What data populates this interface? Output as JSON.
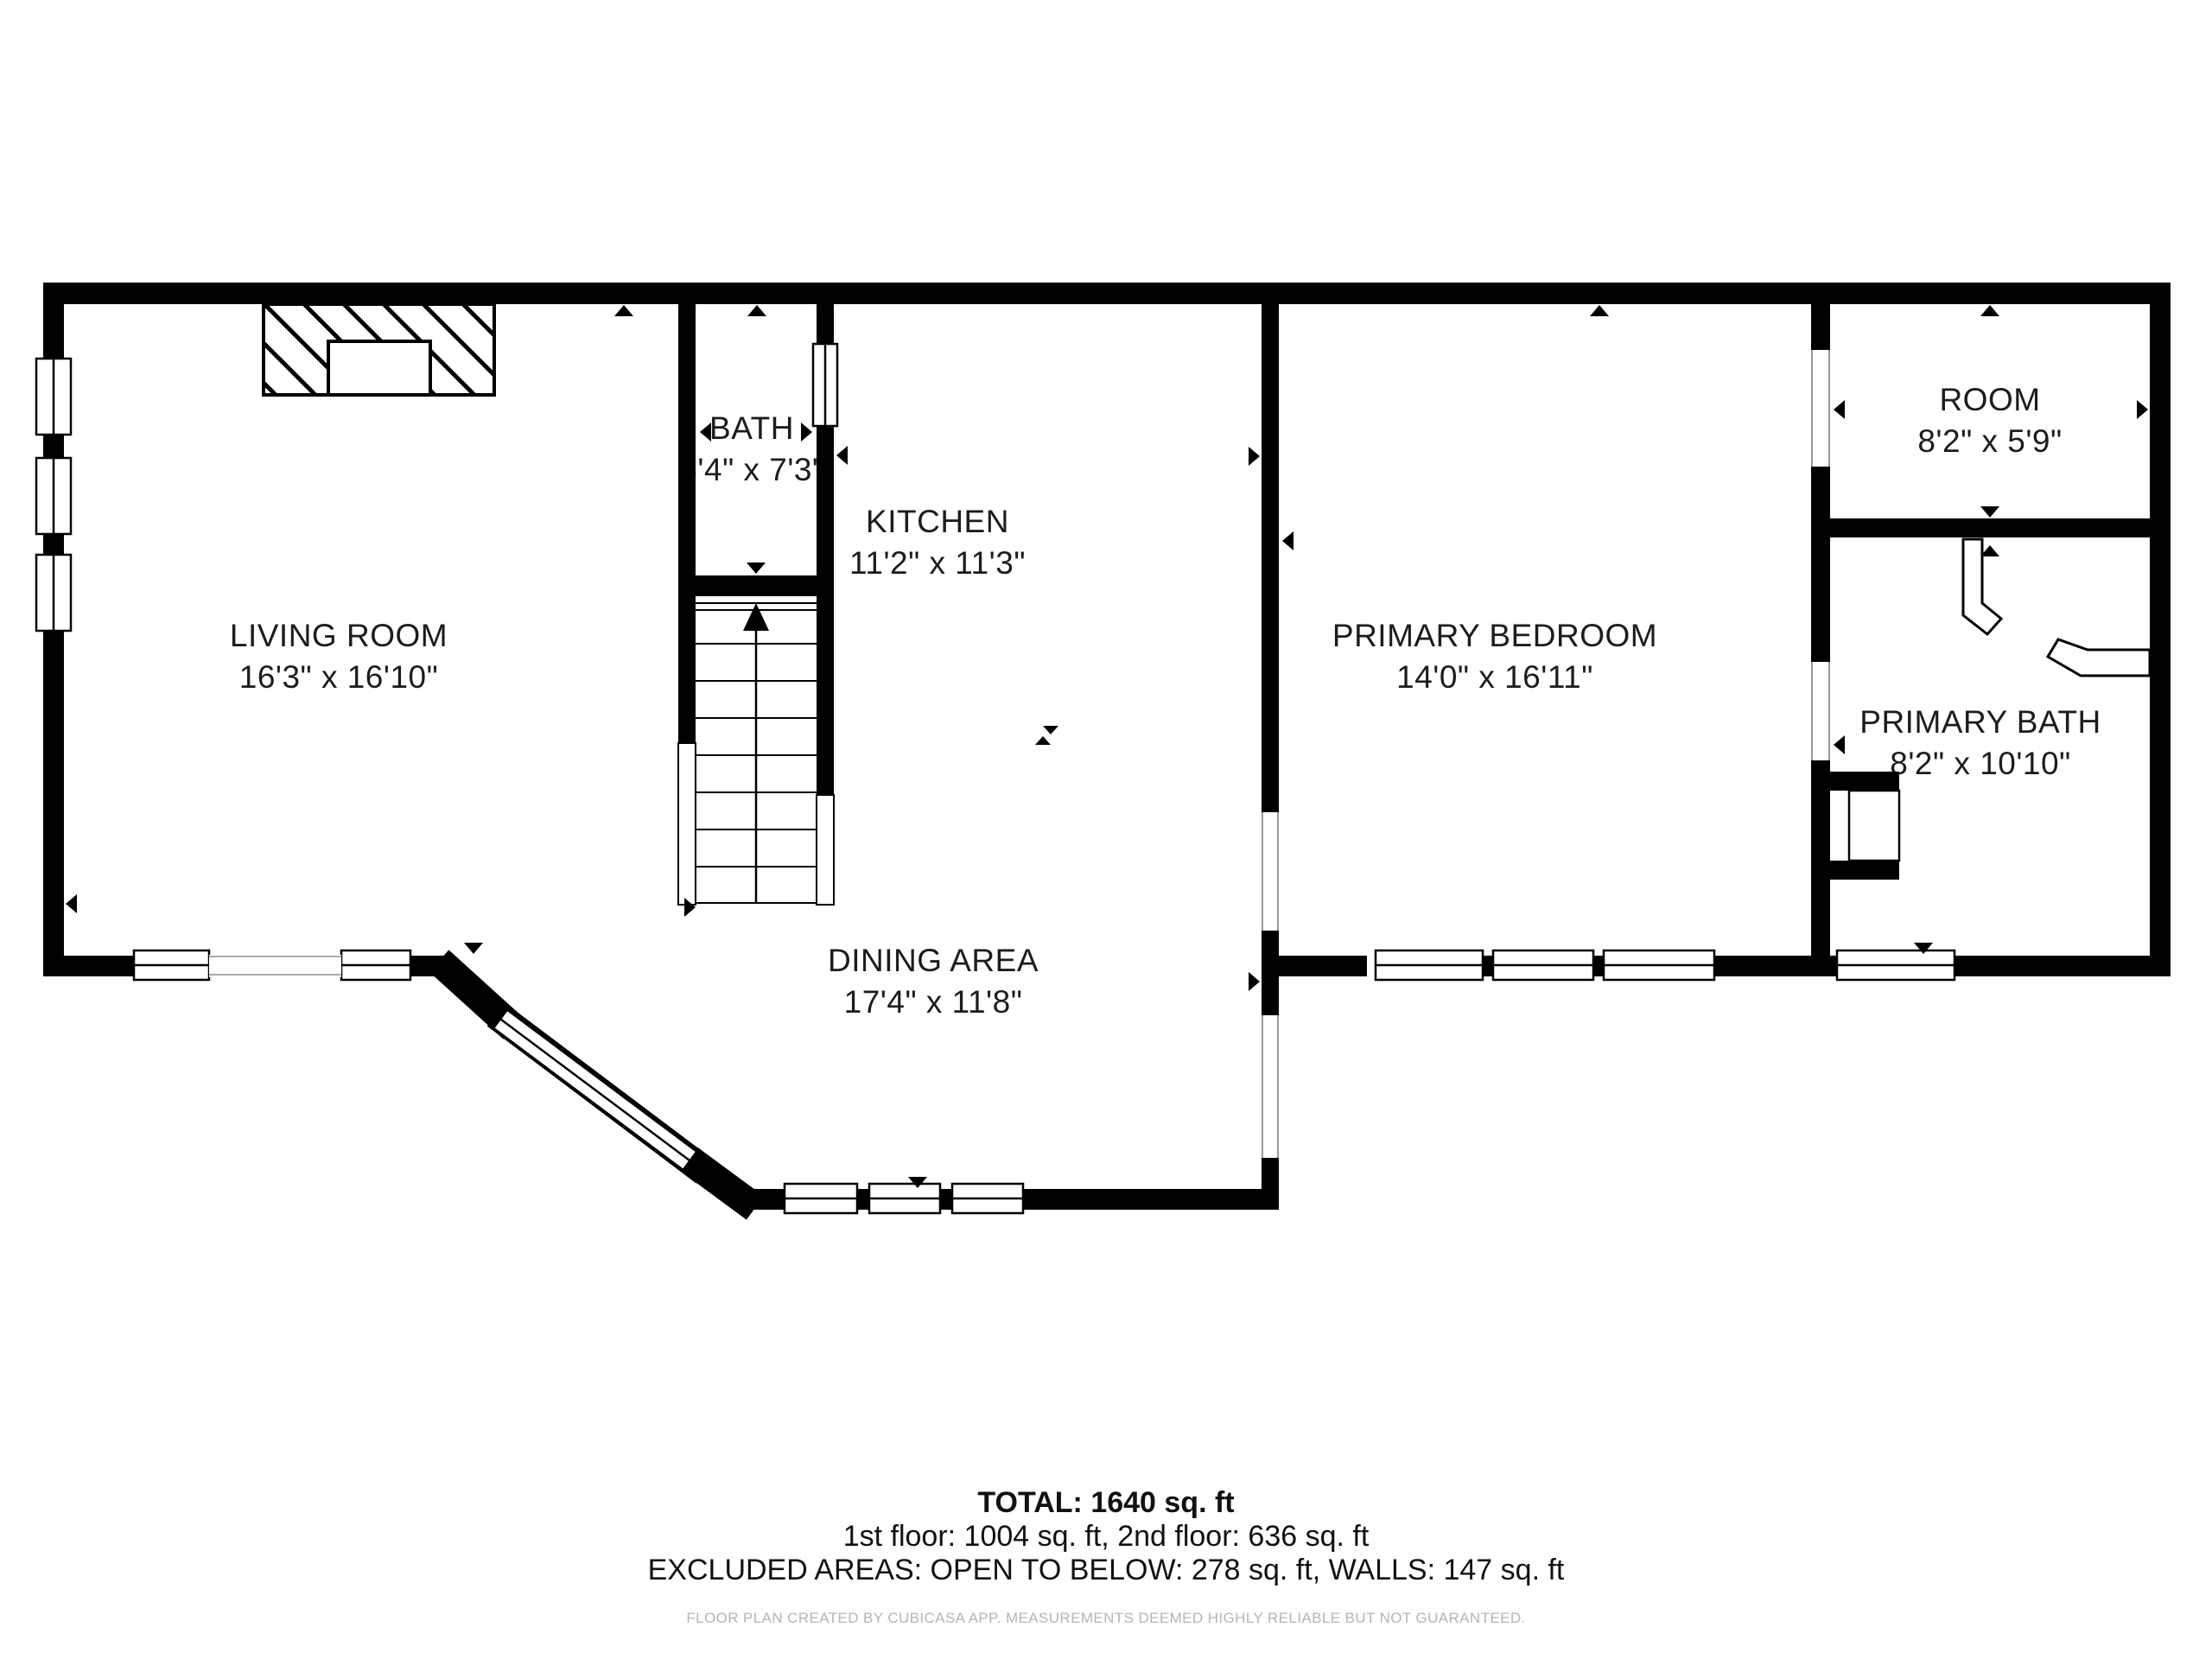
{
  "floor_plan": {
    "rooms": [
      {
        "name": "LIVING ROOM",
        "dims": "16'3\" x 16'10\""
      },
      {
        "name": "BATH",
        "dims": "3'4\" x 7'3\""
      },
      {
        "name": "KITCHEN",
        "dims": "11'2\" x 11'3\""
      },
      {
        "name": "DINING AREA",
        "dims": "17'4\" x 11'8\""
      },
      {
        "name": "PRIMARY BEDROOM",
        "dims": "14'0\" x 16'11\""
      },
      {
        "name": "ROOM",
        "dims": "8'2\" x 5'9\""
      },
      {
        "name": "PRIMARY BATH",
        "dims": "8'2\" x 10'10\""
      }
    ],
    "summary": {
      "total": "TOTAL: 1640 sq. ft",
      "floors": "1st floor: 1004 sq. ft, 2nd floor: 636 sq. ft",
      "excluded": "EXCLUDED AREAS: OPEN TO BELOW: 278 sq. ft, WALLS: 147 sq. ft"
    },
    "disclaimer": "FLOOR PLAN CREATED BY CUBICASA APP. MEASUREMENTS DEEMED HIGHLY RELIABLE BUT NOT GUARANTEED.",
    "colors": {
      "wall": "#000000",
      "background": "#ffffff",
      "label": "#1c1c1c",
      "disclaimer": "#b5b5b5"
    }
  }
}
